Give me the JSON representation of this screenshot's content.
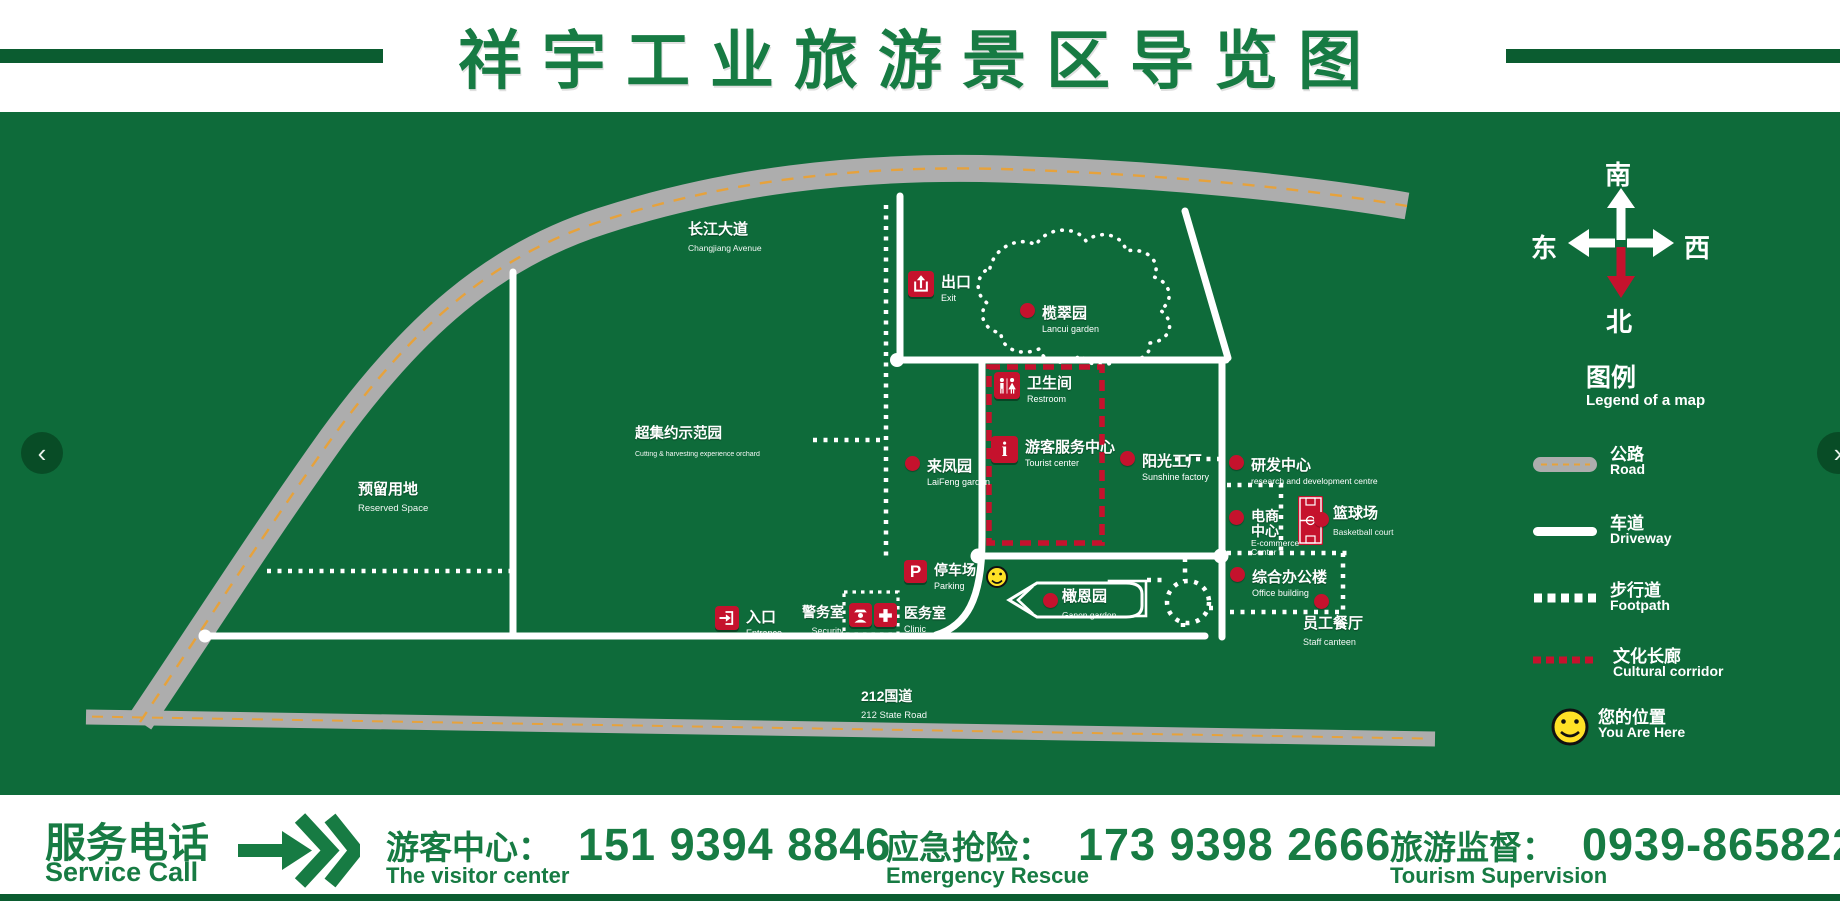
{
  "header": {
    "title": "祥宇工业旅游景区导览图"
  },
  "colors": {
    "green_bg": "#0E6B3A",
    "green_dark": "#0B5C30",
    "green_text": "#177B43",
    "red": "#C5122D",
    "gray_road": "#ADADAD",
    "orange_dash": "#E6A23C",
    "smiley_yellow": "#FFE226"
  },
  "map": {
    "roads": {
      "changjiang": {
        "zh": "长江大道",
        "en": "Changjiang Avenue"
      },
      "g212": {
        "zh": "212国道",
        "en": "212 State Road"
      }
    },
    "areas": {
      "reserved": {
        "zh": "预留用地",
        "en": "Reserved Space"
      },
      "orchard": {
        "zh": "超集约示范园",
        "en": "Cutting & harvesting experience orchard"
      }
    },
    "pois": [
      {
        "zh": "出口",
        "en": "Exit"
      },
      {
        "zh": "榄翠园",
        "en": "Lancui garden"
      },
      {
        "zh": "卫生间",
        "en": "Restroom"
      },
      {
        "zh": "游客服务中心",
        "en": "Tourist center"
      },
      {
        "zh": "来凤园",
        "en": "LaiFeng garden"
      },
      {
        "zh": "阳光工厂",
        "en": "Sunshine factory"
      },
      {
        "zh": "研发中心",
        "en": "research and development centre"
      },
      {
        "zh": "电商",
        "zh2": "中心",
        "en": "E-commerce",
        "en2": "Center"
      },
      {
        "zh": "篮球场",
        "en": "Basketball court"
      },
      {
        "zh": "综合办公楼",
        "en": "Office building"
      },
      {
        "zh": "员工餐厅",
        "en": "Staff canteen"
      },
      {
        "zh": "停车场",
        "en": "Parking"
      },
      {
        "zh": "橄恩园",
        "en": "Ganen garden"
      },
      {
        "zh": "入口",
        "en": "Entrance"
      },
      {
        "zh": "警务室",
        "en": "Security"
      },
      {
        "zh": "医务室",
        "en": "Clinic"
      }
    ]
  },
  "compass": {
    "south": "南",
    "north": "北",
    "east": "东",
    "west": "西"
  },
  "legend": {
    "title_zh": "图例",
    "title_en": "Legend of a map",
    "items": [
      {
        "zh": "公路",
        "en": "Road"
      },
      {
        "zh": "车道",
        "en": "Driveway"
      },
      {
        "zh": "步行道",
        "en": "Footpath"
      },
      {
        "zh": "文化长廊",
        "en": "Cultural corridor"
      },
      {
        "zh": "您的位置",
        "en": "You Are Here"
      }
    ]
  },
  "carousel": {
    "prev": "‹",
    "next": "›"
  },
  "footer": {
    "service_zh": "服务电话",
    "service_en": "Service Call",
    "entries": [
      {
        "zh": "游客中心：",
        "en": "The visitor center",
        "phone": "151 9394 8846"
      },
      {
        "zh": "应急抢险：",
        "en": "Emergency Rescue",
        "phone": "173 9398 2666"
      },
      {
        "zh": "旅游监督：",
        "en": "Tourism Supervision",
        "phone": "0939-8658222"
      }
    ]
  }
}
